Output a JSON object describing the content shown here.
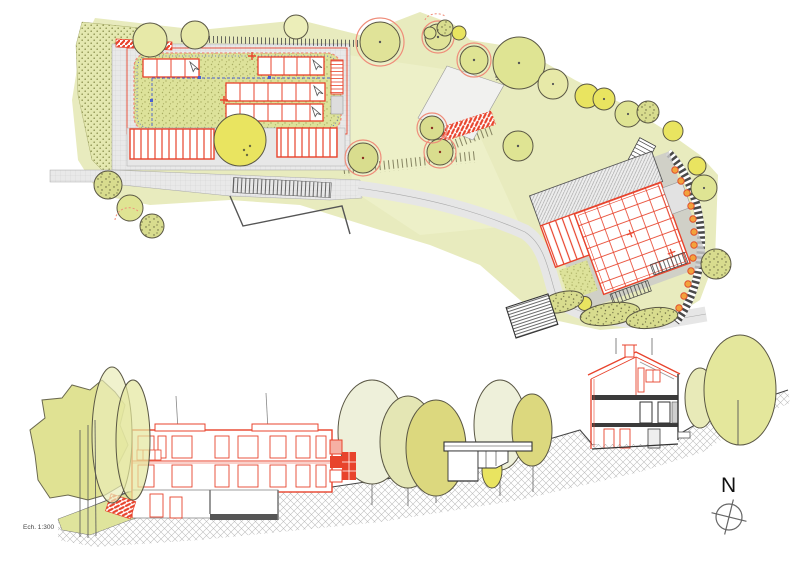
{
  "labels": {
    "scale": "Ech. 1:300",
    "north": "N"
  },
  "palette": {
    "red": "#e8432c",
    "red-soft": "#ef8d7a",
    "blue": "#4a5fd0",
    "ink": "#3a3a3a",
    "veg-pale": "#eef0d0",
    "veg": "#e8ebbe",
    "veg-mid": "#dfe49c",
    "veg-bright": "#e9e460",
    "olive": "#cdd27a",
    "tree-line": "#5a5744",
    "path-gray": "#e9e9e9",
    "plate-gray": "#dedede",
    "shadow-gray": "#c9c9c9",
    "hatch-gray": "#bcbcbc",
    "orange": "#f2a33c",
    "paper": "#ffffff"
  },
  "icons": {
    "north_compass": "compass-crosshair-icon",
    "roof_vent_arrows": "cursor-arrow-icon",
    "car": "car-top-view-icon"
  }
}
